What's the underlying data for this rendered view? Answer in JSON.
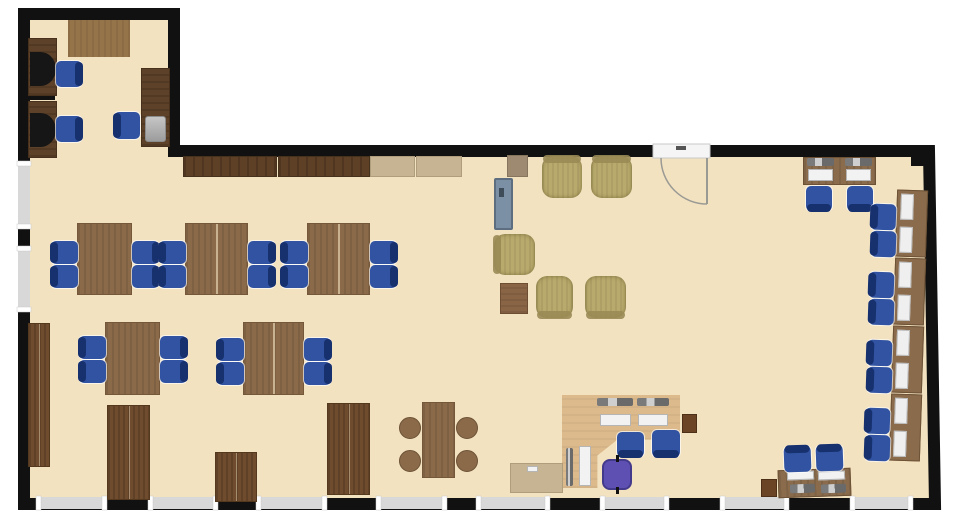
{
  "floorplan": {
    "canvas": {
      "w": 957,
      "h": 530
    },
    "colors": {
      "floor": "#f3e2c0",
      "wall": "#111111",
      "window": "#d8d8d8",
      "window_cap": "#ffffff",
      "door": "#f5f5f5",
      "door_line": "#9a9a94"
    },
    "wall_thickness": 12,
    "outline": [
      [
        24,
        14
      ],
      [
        174,
        14
      ],
      [
        174,
        151
      ],
      [
        929,
        151
      ],
      [
        935,
        504
      ],
      [
        24,
        504
      ]
    ],
    "corner_block": {
      "x": 911,
      "y": 146,
      "w": 22,
      "h": 20
    },
    "windows": [
      {
        "x": 38,
        "y": 497,
        "w": 67,
        "h": 12
      },
      {
        "x": 150,
        "y": 497,
        "w": 66,
        "h": 12
      },
      {
        "x": 258,
        "y": 497,
        "w": 67,
        "h": 12
      },
      {
        "x": 378,
        "y": 497,
        "w": 67,
        "h": 12
      },
      {
        "x": 478,
        "y": 497,
        "w": 70,
        "h": 12
      },
      {
        "x": 602,
        "y": 497,
        "w": 65,
        "h": 12
      },
      {
        "x": 722,
        "y": 497,
        "w": 65,
        "h": 12
      },
      {
        "x": 852,
        "y": 497,
        "w": 59,
        "h": 12
      },
      {
        "x": 18,
        "y": 163,
        "w": 12,
        "h": 64
      },
      {
        "x": 18,
        "y": 248,
        "w": 12,
        "h": 62
      }
    ],
    "door": {
      "gap": {
        "x": 653,
        "y": 144,
        "w": 57,
        "h": 14
      },
      "hinge": [
        707,
        158
      ],
      "radius": 46,
      "arc_start": [
        661,
        158
      ],
      "arc_end": [
        707,
        204
      ],
      "tick": {
        "x": 676,
        "y": 146,
        "w": 10,
        "h": 4
      }
    },
    "items": [
      {
        "n": "table",
        "t": "wood-light",
        "x": 68,
        "y": 20,
        "w": 62,
        "h": 37
      },
      {
        "n": "computer-desk",
        "t": "desk-dark",
        "x": 28,
        "y": 38,
        "w": 29,
        "h": 58
      },
      {
        "n": "monitor",
        "t": "monitor",
        "x": 30,
        "y": 52,
        "w": 26,
        "h": 34
      },
      {
        "n": "desk-chair",
        "t": "chair-blue",
        "x": 56,
        "y": 61,
        "w": 26,
        "h": 26,
        "b": "right"
      },
      {
        "n": "partition",
        "t": "partition",
        "x": 28,
        "y": 96,
        "w": 27,
        "h": 4
      },
      {
        "n": "computer-desk",
        "t": "desk-dark",
        "x": 28,
        "y": 101,
        "w": 29,
        "h": 57
      },
      {
        "n": "monitor",
        "t": "monitor",
        "x": 30,
        "y": 113,
        "w": 26,
        "h": 34
      },
      {
        "n": "desk-chair",
        "t": "chair-blue",
        "x": 56,
        "y": 116,
        "w": 26,
        "h": 26,
        "b": "right"
      },
      {
        "n": "computer-desk",
        "t": "desk-dark",
        "x": 141,
        "y": 68,
        "w": 29,
        "h": 79
      },
      {
        "n": "printer",
        "t": "device",
        "x": 145,
        "y": 116,
        "w": 21,
        "h": 26
      },
      {
        "n": "desk-chair",
        "t": "chair-blue",
        "x": 114,
        "y": 112,
        "w": 26,
        "h": 27,
        "b": "left"
      },
      {
        "n": "counter",
        "t": "counter-dark",
        "x": 183,
        "y": 156,
        "w": 94,
        "h": 21
      },
      {
        "n": "counter",
        "t": "counter-dark",
        "x": 278,
        "y": 156,
        "w": 92,
        "h": 21
      },
      {
        "n": "counter",
        "t": "counter-light",
        "x": 370,
        "y": 156,
        "w": 45,
        "h": 21
      },
      {
        "n": "counter",
        "t": "counter-light",
        "x": 416,
        "y": 156,
        "w": 46,
        "h": 21
      },
      {
        "n": "cabinet",
        "t": "cabinet-tan",
        "x": 507,
        "y": 155,
        "w": 21,
        "h": 22
      },
      {
        "n": "whiteboard",
        "t": "board",
        "x": 494,
        "y": 178,
        "w": 19,
        "h": 52
      },
      {
        "n": "armchair",
        "t": "armchair",
        "x": 542,
        "y": 156,
        "w": 40,
        "h": 42,
        "b": "top"
      },
      {
        "n": "armchair",
        "t": "armchair",
        "x": 591,
        "y": 156,
        "w": 41,
        "h": 42,
        "b": "top"
      },
      {
        "n": "armchair",
        "t": "armchair",
        "x": 494,
        "y": 234,
        "w": 41,
        "h": 41,
        "b": "left"
      },
      {
        "n": "coffee-table",
        "t": "side-table",
        "x": 500,
        "y": 283,
        "w": 28,
        "h": 31
      },
      {
        "n": "armchair",
        "t": "armchair",
        "x": 536,
        "y": 276,
        "w": 37,
        "h": 42,
        "b": "bottom"
      },
      {
        "n": "armchair",
        "t": "armchair",
        "x": 585,
        "y": 276,
        "w": 41,
        "h": 42,
        "b": "bottom"
      },
      {
        "n": "work-table",
        "t": "table-wood",
        "x": 77,
        "y": 223,
        "w": 55,
        "h": 72
      },
      {
        "n": "chair",
        "t": "chair-blue",
        "x": 51,
        "y": 241,
        "w": 27,
        "h": 23,
        "b": "left"
      },
      {
        "n": "chair",
        "t": "chair-blue",
        "x": 51,
        "y": 265,
        "w": 27,
        "h": 23,
        "b": "left"
      },
      {
        "n": "chair",
        "t": "chair-blue",
        "x": 132,
        "y": 241,
        "w": 27,
        "h": 23,
        "b": "right"
      },
      {
        "n": "chair",
        "t": "chair-blue",
        "x": 132,
        "y": 265,
        "w": 27,
        "h": 23,
        "b": "right"
      },
      {
        "n": "work-table",
        "t": "table-wood2",
        "x": 185,
        "y": 223,
        "w": 63,
        "h": 72
      },
      {
        "n": "chair",
        "t": "chair-blue",
        "x": 159,
        "y": 241,
        "w": 27,
        "h": 23,
        "b": "left"
      },
      {
        "n": "chair",
        "t": "chair-blue",
        "x": 159,
        "y": 265,
        "w": 27,
        "h": 23,
        "b": "left"
      },
      {
        "n": "chair",
        "t": "chair-blue",
        "x": 248,
        "y": 241,
        "w": 27,
        "h": 23,
        "b": "right"
      },
      {
        "n": "chair",
        "t": "chair-blue",
        "x": 248,
        "y": 265,
        "w": 27,
        "h": 23,
        "b": "right"
      },
      {
        "n": "work-table",
        "t": "table-wood2",
        "x": 307,
        "y": 223,
        "w": 63,
        "h": 72
      },
      {
        "n": "chair",
        "t": "chair-blue",
        "x": 281,
        "y": 241,
        "w": 27,
        "h": 23,
        "b": "left"
      },
      {
        "n": "chair",
        "t": "chair-blue",
        "x": 281,
        "y": 265,
        "w": 27,
        "h": 23,
        "b": "left"
      },
      {
        "n": "chair",
        "t": "chair-blue",
        "x": 370,
        "y": 241,
        "w": 27,
        "h": 23,
        "b": "right"
      },
      {
        "n": "chair",
        "t": "chair-blue",
        "x": 370,
        "y": 265,
        "w": 27,
        "h": 23,
        "b": "right"
      },
      {
        "n": "work-table",
        "t": "table-wood",
        "x": 105,
        "y": 322,
        "w": 55,
        "h": 73
      },
      {
        "n": "chair",
        "t": "chair-blue",
        "x": 79,
        "y": 336,
        "w": 27,
        "h": 23,
        "b": "left"
      },
      {
        "n": "chair",
        "t": "chair-blue",
        "x": 79,
        "y": 360,
        "w": 27,
        "h": 23,
        "b": "left"
      },
      {
        "n": "chair",
        "t": "chair-blue",
        "x": 160,
        "y": 336,
        "w": 27,
        "h": 23,
        "b": "right"
      },
      {
        "n": "chair",
        "t": "chair-blue",
        "x": 160,
        "y": 360,
        "w": 27,
        "h": 23,
        "b": "right"
      },
      {
        "n": "work-table",
        "t": "table-wood2",
        "x": 243,
        "y": 322,
        "w": 61,
        "h": 73
      },
      {
        "n": "chair",
        "t": "chair-blue",
        "x": 217,
        "y": 338,
        "w": 27,
        "h": 23,
        "b": "left"
      },
      {
        "n": "chair",
        "t": "chair-blue",
        "x": 217,
        "y": 362,
        "w": 27,
        "h": 23,
        "b": "left"
      },
      {
        "n": "chair",
        "t": "chair-blue",
        "x": 304,
        "y": 338,
        "w": 27,
        "h": 23,
        "b": "right"
      },
      {
        "n": "chair",
        "t": "chair-blue",
        "x": 304,
        "y": 362,
        "w": 27,
        "h": 23,
        "b": "right"
      },
      {
        "n": "storage-cabinet",
        "t": "cabinet",
        "x": 28,
        "y": 323,
        "w": 22,
        "h": 144
      },
      {
        "n": "storage-cabinet",
        "t": "cabinet",
        "x": 107,
        "y": 405,
        "w": 43,
        "h": 95
      },
      {
        "n": "storage-cabinet",
        "t": "cabinet",
        "x": 215,
        "y": 452,
        "w": 42,
        "h": 50
      },
      {
        "n": "storage-cabinet",
        "t": "cabinet",
        "x": 327,
        "y": 403,
        "w": 43,
        "h": 92
      },
      {
        "n": "lunch-table",
        "t": "table-wood",
        "x": 422,
        "y": 402,
        "w": 33,
        "h": 76
      },
      {
        "n": "stool",
        "t": "stool",
        "x": 399,
        "y": 417,
        "w": 22,
        "h": 22
      },
      {
        "n": "stool",
        "t": "stool",
        "x": 456,
        "y": 417,
        "w": 22,
        "h": 22
      },
      {
        "n": "stool",
        "t": "stool",
        "x": 399,
        "y": 450,
        "w": 22,
        "h": 22
      },
      {
        "n": "stool",
        "t": "stool",
        "x": 456,
        "y": 450,
        "w": 22,
        "h": 22
      },
      {
        "n": "computer-desk",
        "t": "desk-mid",
        "x": 803,
        "y": 157,
        "w": 73,
        "h": 28
      },
      {
        "n": "equipment",
        "t": "equip",
        "x": 807,
        "y": 158,
        "w": 27,
        "h": 8
      },
      {
        "n": "equipment",
        "t": "equip",
        "x": 845,
        "y": 158,
        "w": 27,
        "h": 8
      },
      {
        "n": "keyboard",
        "t": "keyboard",
        "x": 808,
        "y": 169,
        "w": 25,
        "h": 12
      },
      {
        "n": "keyboard",
        "t": "keyboard",
        "x": 846,
        "y": 169,
        "w": 25,
        "h": 12
      },
      {
        "n": "desk-chair",
        "t": "chair-blue",
        "x": 806,
        "y": 186,
        "w": 26,
        "h": 25,
        "b": "bottom"
      },
      {
        "n": "desk-chair",
        "t": "chair-blue",
        "x": 847,
        "y": 186,
        "w": 26,
        "h": 25,
        "b": "bottom"
      },
      {
        "n": "computer-desk",
        "t": "desk-col",
        "x": 896,
        "y": 190,
        "w": 31,
        "h": 67,
        "r": 2
      },
      {
        "n": "computer-desk",
        "t": "desk-col",
        "x": 894,
        "y": 258,
        "w": 31,
        "h": 67,
        "r": 2
      },
      {
        "n": "computer-desk",
        "t": "desk-col",
        "x": 892,
        "y": 326,
        "w": 31,
        "h": 67,
        "r": 2
      },
      {
        "n": "computer-desk",
        "t": "desk-col",
        "x": 890,
        "y": 394,
        "w": 31,
        "h": 67,
        "r": 2
      },
      {
        "n": "desk-chair",
        "t": "chair-blue",
        "x": 871,
        "y": 204,
        "w": 25,
        "h": 26,
        "b": "left",
        "r": 2
      },
      {
        "n": "desk-chair",
        "t": "chair-blue",
        "x": 871,
        "y": 231,
        "w": 25,
        "h": 26,
        "b": "left",
        "r": 2
      },
      {
        "n": "desk-chair",
        "t": "chair-blue",
        "x": 869,
        "y": 272,
        "w": 25,
        "h": 26,
        "b": "left",
        "r": 2
      },
      {
        "n": "desk-chair",
        "t": "chair-blue",
        "x": 869,
        "y": 299,
        "w": 25,
        "h": 26,
        "b": "left",
        "r": 2
      },
      {
        "n": "desk-chair",
        "t": "chair-blue",
        "x": 867,
        "y": 340,
        "w": 25,
        "h": 26,
        "b": "left",
        "r": 2
      },
      {
        "n": "desk-chair",
        "t": "chair-blue",
        "x": 867,
        "y": 367,
        "w": 25,
        "h": 26,
        "b": "left",
        "r": 2
      },
      {
        "n": "desk-chair",
        "t": "chair-blue",
        "x": 865,
        "y": 408,
        "w": 25,
        "h": 26,
        "b": "left",
        "r": 2
      },
      {
        "n": "desk-chair",
        "t": "chair-blue",
        "x": 865,
        "y": 435,
        "w": 25,
        "h": 26,
        "b": "left",
        "r": 2
      },
      {
        "n": "reception-desk",
        "t": "ldesk",
        "x": 562,
        "y": 395,
        "w": 118,
        "h": 93
      },
      {
        "n": "equipment",
        "t": "equip",
        "x": 597,
        "y": 398,
        "w": 36,
        "h": 8
      },
      {
        "n": "equipment",
        "t": "equip",
        "x": 637,
        "y": 398,
        "w": 32,
        "h": 8
      },
      {
        "n": "keyboard",
        "t": "keyboard",
        "x": 600,
        "y": 414,
        "w": 31,
        "h": 12
      },
      {
        "n": "keyboard",
        "t": "keyboard",
        "x": 638,
        "y": 414,
        "w": 30,
        "h": 12
      },
      {
        "n": "equipment",
        "t": "equip",
        "x": 566,
        "y": 448,
        "w": 7,
        "h": 38
      },
      {
        "n": "keyboard",
        "t": "keyboard",
        "x": 579,
        "y": 446,
        "w": 12,
        "h": 40
      },
      {
        "n": "storage-box",
        "t": "box",
        "x": 682,
        "y": 414,
        "w": 15,
        "h": 19
      },
      {
        "n": "desk-chair",
        "t": "chair-blue",
        "x": 617,
        "y": 432,
        "w": 27,
        "h": 25,
        "b": "bottom"
      },
      {
        "n": "desk-chair",
        "t": "chair-blue",
        "x": 652,
        "y": 430,
        "w": 28,
        "h": 27,
        "b": "bottom"
      },
      {
        "n": "task-chair",
        "t": "chair-purple",
        "x": 602,
        "y": 459,
        "w": 30,
        "h": 31
      },
      {
        "n": "side-table",
        "t": "counter-light",
        "x": 510,
        "y": 463,
        "w": 53,
        "h": 30
      },
      {
        "n": "paper",
        "t": "keyboard",
        "x": 527,
        "y": 466,
        "w": 11,
        "h": 6
      },
      {
        "n": "computer-desk",
        "t": "desk-mid",
        "x": 778,
        "y": 469,
        "w": 73,
        "h": 28,
        "r": -2
      },
      {
        "n": "keyboard",
        "t": "keyboard",
        "x": 787,
        "y": 471,
        "w": 27,
        "h": 9,
        "r": -2
      },
      {
        "n": "keyboard",
        "t": "keyboard",
        "x": 818,
        "y": 471,
        "w": 27,
        "h": 9,
        "r": -2
      },
      {
        "n": "equipment",
        "t": "equip",
        "x": 790,
        "y": 484,
        "w": 25,
        "h": 9,
        "r": -2
      },
      {
        "n": "equipment",
        "t": "equip",
        "x": 821,
        "y": 484,
        "w": 25,
        "h": 9,
        "r": -2
      },
      {
        "n": "desk-chair",
        "t": "chair-blue",
        "x": 784,
        "y": 446,
        "w": 27,
        "h": 26,
        "b": "top",
        "r": -2
      },
      {
        "n": "desk-chair",
        "t": "chair-blue",
        "x": 816,
        "y": 445,
        "w": 27,
        "h": 26,
        "b": "top",
        "r": -2
      },
      {
        "n": "storage-box",
        "t": "box",
        "x": 761,
        "y": 479,
        "w": 16,
        "h": 18
      }
    ]
  }
}
